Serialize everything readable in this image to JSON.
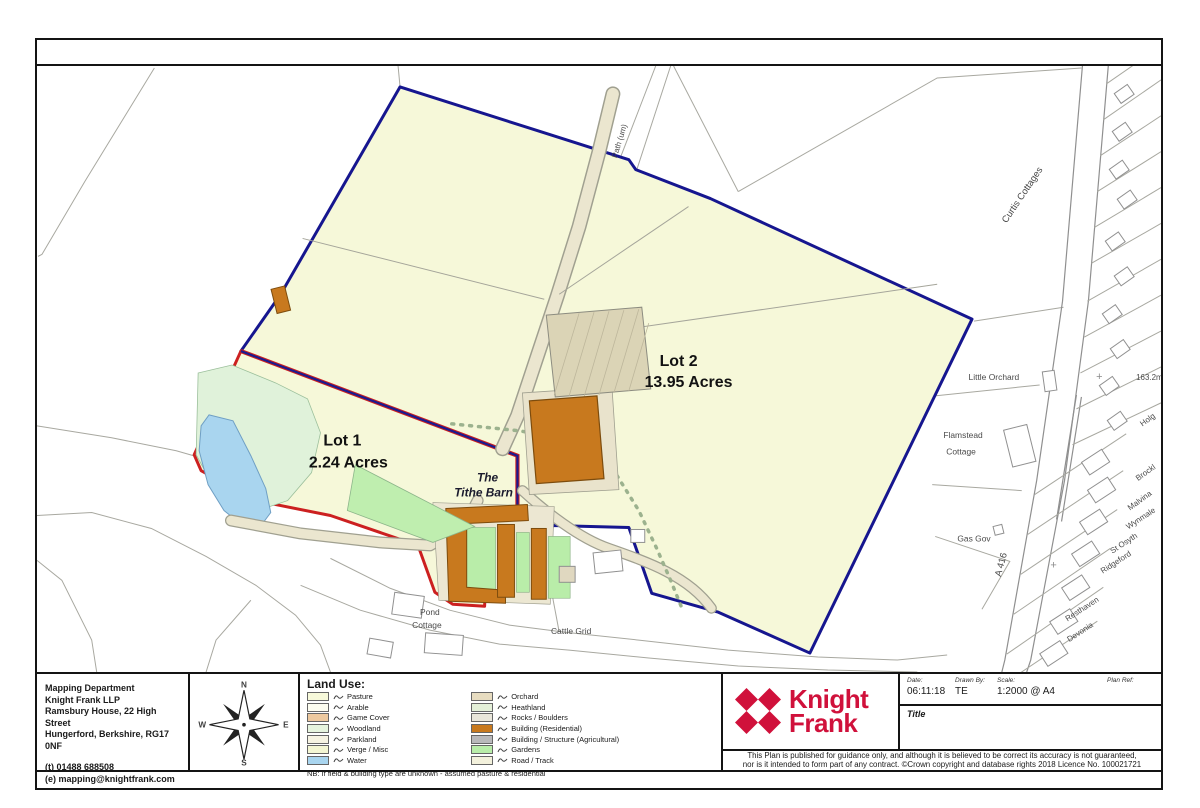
{
  "map": {
    "labels": {
      "lot1_title": "Lot 1",
      "lot1_area": "2.24 Acres",
      "lot2_title": "Lot 2",
      "lot2_area": "13.95 Acres",
      "tithe_the": "The",
      "tithe_barn": "Tithe Barn",
      "tithe_barn_small": "Tithe Barn",
      "pond": "Pond",
      "pond_cottage": "Cottage",
      "cattle_grid": "Cattle Grid",
      "path_um": "Path (um)",
      "curtis_cottages": "Curtis Cottages",
      "little_orchard": "Little Orchard",
      "spot_height": "163.2m",
      "flamstead": "Flamstead",
      "flamstead_cottage": "Cottage",
      "gas_gov": "Gas Gov",
      "a416": "A 416",
      "brock": "Brockl",
      "malvina": "Malvina",
      "wynmale": "Wynmale",
      "st_osyth": "St Osyth",
      "ridgeford": "Ridgeford",
      "resthaven": "Resthaven",
      "devonia": "Devonia",
      "holg": "Holg"
    },
    "symbols": {
      "plus1": "+",
      "plus2": "+"
    },
    "colors": {
      "boundary_blue": "#16168f",
      "boundary_red": "#cc2020",
      "lot_fill": "#f6f8d9",
      "water": "#a9d5ef",
      "garden": "#b9eda9",
      "heath": "#e0f2da",
      "track": "#ebe6cf",
      "building_residential": "#c8791e",
      "building_agricultural": "#dbd4b6"
    }
  },
  "footer": {
    "address": {
      "lines": [
        "Mapping Department",
        "Knight Frank LLP",
        "Ramsbury House, 22 High Street",
        "Hungerford, Berkshire, RG17 0NF",
        "(t) 01488 688508",
        "(e) mapping@knightfrank.com"
      ]
    },
    "compass": {
      "n": "N",
      "e": "E",
      "s": "S",
      "w": "W"
    },
    "legend": {
      "title": "Land Use:",
      "note": "NB: If field & building type are unknown - assumed pasture & residential",
      "col1": [
        {
          "label": "Pasture",
          "style": "background:#f7f9da"
        },
        {
          "label": "Arable",
          "style": "background:#fdfdf0"
        },
        {
          "label": "Game Cover",
          "style": "background:#edc99f"
        },
        {
          "label": "Woodland",
          "style": "background:#e6f4de"
        },
        {
          "label": "Parkland",
          "style": "background:#f6f3e2"
        },
        {
          "label": "Verge / Misc",
          "style": "background:#f4f6d3"
        },
        {
          "label": "Water",
          "style": "background:#a9d5ef"
        }
      ],
      "col2": [
        {
          "label": "Orchard",
          "style": "background:#e7dcc0"
        },
        {
          "label": "Heathland",
          "style": "background:#e4f0d8"
        },
        {
          "label": "Rocks / Boulders",
          "style": "background:#e9e6da"
        },
        {
          "label": "Building (Residential)",
          "style": "background:#c8791e"
        },
        {
          "label": "Building / Structure (Agricultural)",
          "style": "background:#b9b9bb"
        },
        {
          "label": "Gardens",
          "style": "background:#b9eda9"
        },
        {
          "label": "Road / Track",
          "style": "background:#f3f1dc"
        }
      ]
    },
    "brand": {
      "line1": "Knight",
      "line2": "Frank",
      "color": "#d0113b"
    },
    "titleblock": {
      "date_label": "Date:",
      "date": "06:11:18",
      "drawn_label": "Drawn By:",
      "drawn": "TE",
      "scale_label": "Scale:",
      "scale": "1:2000 @ A4",
      "ref_label": "Plan Ref:",
      "ref": "",
      "title_label": "Title"
    },
    "disclaimer": {
      "line1": "This Plan is published for guidance only, and although it is believed to be correct its accuracy is not guaranteed,",
      "line2": "nor is it intended to form part of any contract. ©Crown copyright and database rights 2018 Licence No. 100021721"
    }
  }
}
